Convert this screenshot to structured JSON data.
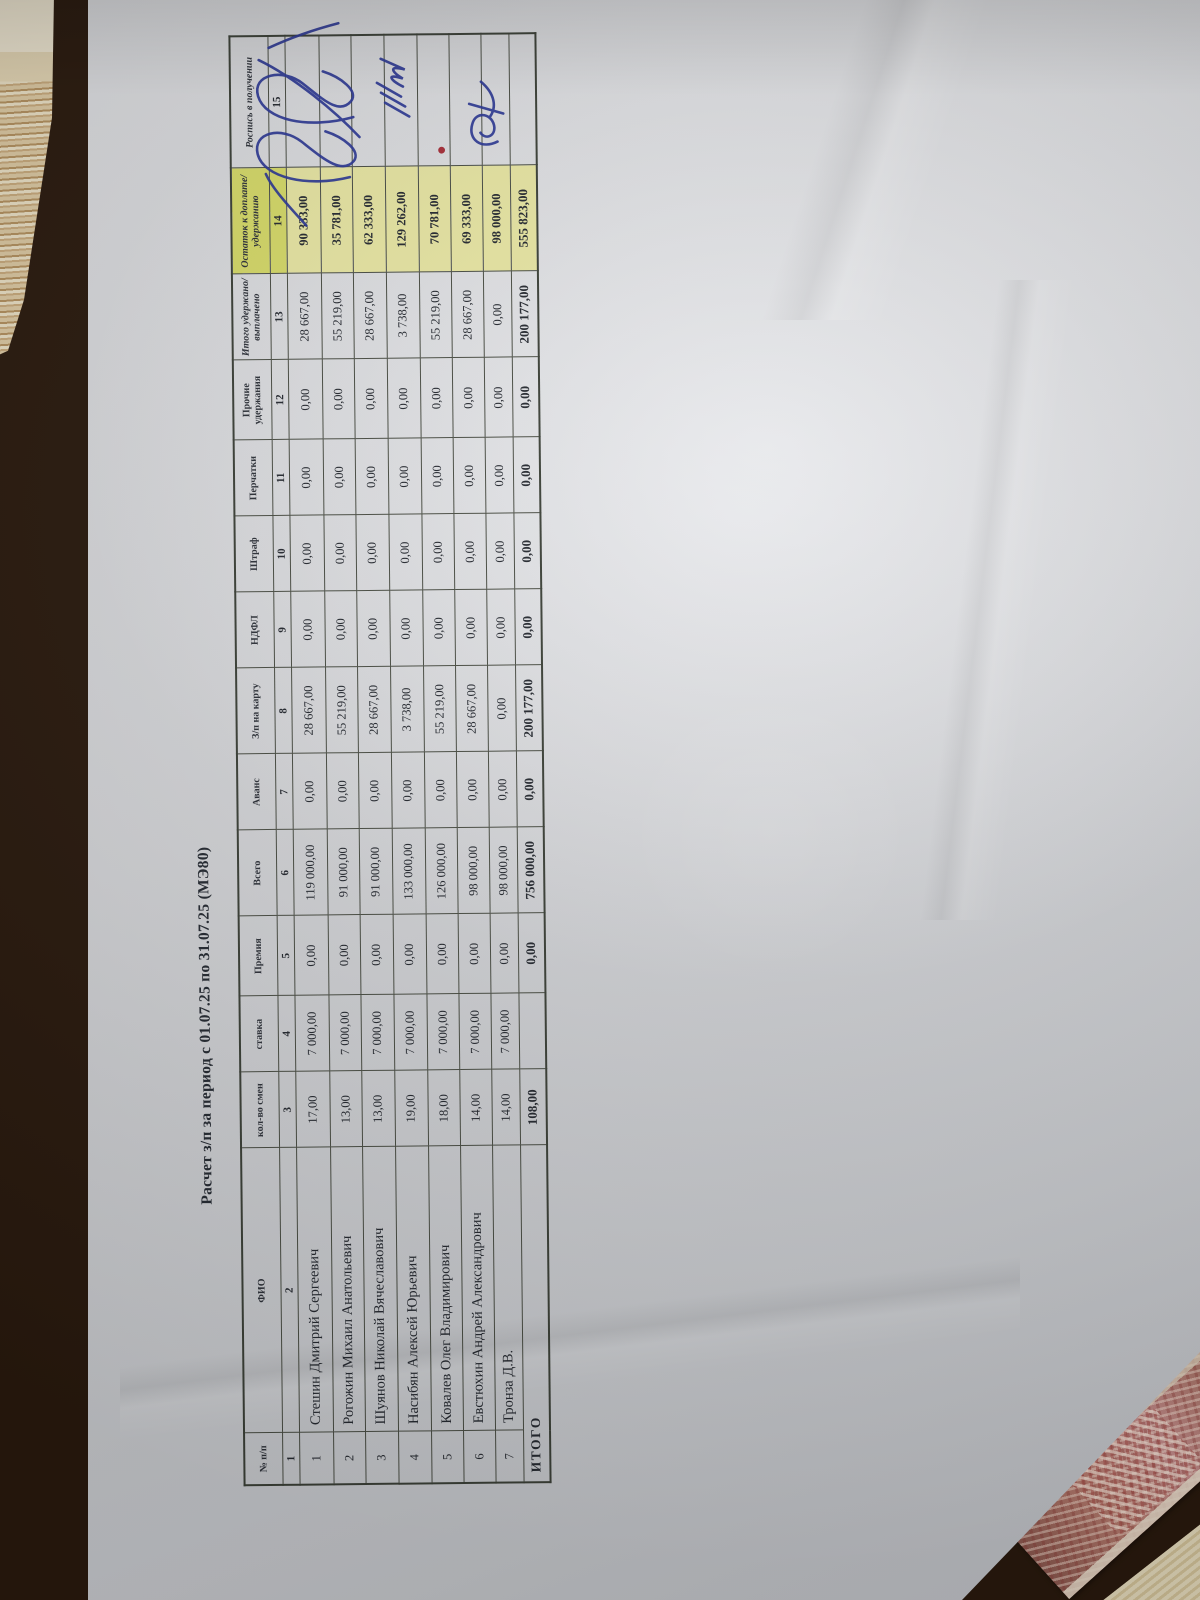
{
  "colors": {
    "highlight_yellow_header": "#d7db69",
    "highlight_yellow_cell": "#e9e7a4",
    "ink_blue": "#2c3896",
    "mark_red": "#a82f3a",
    "grid_line": "#4a4e44",
    "paper": "#d5d6d9",
    "wood": "#4e2d18"
  },
  "document": {
    "title": "Расчет з/п за период с 01.07.25 по 31.07.25 (МЭ80)",
    "table": {
      "columns": [
        {
          "num": "1",
          "label": "№ п/п"
        },
        {
          "num": "2",
          "label": "ФИО"
        },
        {
          "num": "3",
          "label": "кол-во смен"
        },
        {
          "num": "4",
          "label": "ставка"
        },
        {
          "num": "5",
          "label": "Премия"
        },
        {
          "num": "6",
          "label": "Всего"
        },
        {
          "num": "7",
          "label": "Аванс"
        },
        {
          "num": "8",
          "label": "З/п на карту"
        },
        {
          "num": "9",
          "label": "НДФЛ"
        },
        {
          "num": "10",
          "label": "Штраф"
        },
        {
          "num": "11",
          "label": "Перчатки"
        },
        {
          "num": "12",
          "label": "Прочие удержания"
        },
        {
          "num": "13",
          "label": "Итого удержано/ выплачено"
        },
        {
          "num": "14",
          "label": "Остаток к доплате/ удержанию"
        },
        {
          "num": "15",
          "label": "Роспись в получении"
        }
      ],
      "rows": [
        {
          "num": "1",
          "fio": "Стешин Дмитрий Сергеевич",
          "values": [
            "17,00",
            "7 000,00",
            "0,00",
            "119 000,00",
            "0,00",
            "28 667,00",
            "0,00",
            "0,00",
            "0,00",
            "0,00",
            "28 667,00"
          ],
          "remainder": "90 333,00",
          "mark": "blue-signature"
        },
        {
          "num": "2",
          "fio": "Рогожин Михаил Анатольевич",
          "values": [
            "13,00",
            "7 000,00",
            "0,00",
            "91 000,00",
            "0,00",
            "55 219,00",
            "0,00",
            "0,00",
            "0,00",
            "0,00",
            "55 219,00"
          ],
          "remainder": "35 781,00",
          "mark": "blue-signature"
        },
        {
          "num": "3",
          "fio": "Шуянов Николай Вячеславович",
          "values": [
            "13,00",
            "7 000,00",
            "0,00",
            "91 000,00",
            "0,00",
            "28 667,00",
            "0,00",
            "0,00",
            "0,00",
            "0,00",
            "28 667,00"
          ],
          "remainder": "62 333,00",
          "mark": ""
        },
        {
          "num": "4",
          "fio": "Насибян Алексей Юрьевич",
          "values": [
            "19,00",
            "7 000,00",
            "0,00",
            "133 000,00",
            "0,00",
            "3 738,00",
            "0,00",
            "0,00",
            "0,00",
            "0,00",
            "3 738,00"
          ],
          "remainder": "129 262,00",
          "mark": "blue-signature"
        },
        {
          "num": "5",
          "fio": "Ковалев Олег Владимирович",
          "values": [
            "18,00",
            "7 000,00",
            "0,00",
            "126 000,00",
            "0,00",
            "55 219,00",
            "0,00",
            "0,00",
            "0,00",
            "0,00",
            "55 219,00"
          ],
          "remainder": "70 781,00",
          "mark": ""
        },
        {
          "num": "6",
          "fio": "Евстюхин Андрей Александрович",
          "values": [
            "14,00",
            "7 000,00",
            "0,00",
            "98 000,00",
            "0,00",
            "28 667,00",
            "0,00",
            "0,00",
            "0,00",
            "0,00",
            "28 667,00"
          ],
          "remainder": "69 333,00",
          "mark": "red-dot"
        },
        {
          "num": "7",
          "fio": "Тронза Д.В.",
          "values": [
            "14,00",
            "7 000,00",
            "0,00",
            "98 000,00",
            "0,00",
            "0,00",
            "0,00",
            "0,00",
            "0,00",
            "0,00",
            "0,00"
          ],
          "remainder": "98 000,00",
          "mark": "blue-signature"
        }
      ],
      "totals": {
        "label": "ИТОГО",
        "values": [
          "108,00",
          "",
          "0,00",
          "756 000,00",
          "0,00",
          "200 177,00",
          "0,00",
          "0,00",
          "0,00",
          "0,00",
          "200 177,00"
        ],
        "remainder": "555 823,00",
        "mark": ""
      }
    }
  }
}
